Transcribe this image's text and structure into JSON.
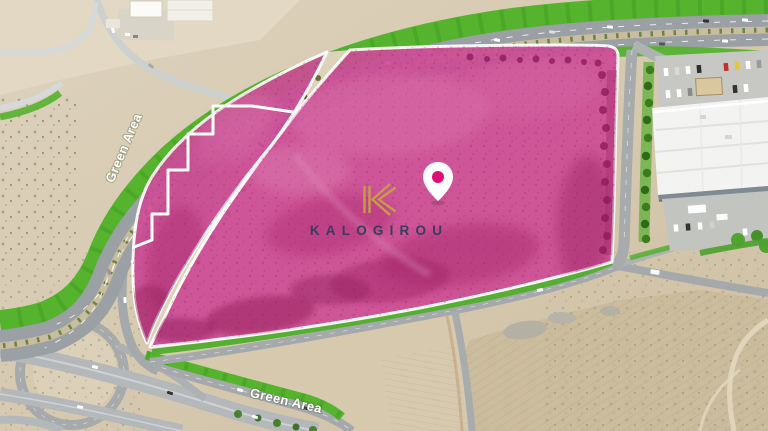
{
  "map": {
    "type": "satellite-aerial-parcel-map",
    "annotations": {
      "green_area_label_left": "Green Area",
      "green_area_label_bottom": "Green Area"
    },
    "brand": {
      "wordmark": "KALOGIROU",
      "logo_icon": "kalogirou-k-monogram"
    },
    "marker": {
      "name": "location-pin"
    },
    "overlay": {
      "highlighted_parcels": 2,
      "boundary_style": "white-outline"
    },
    "colors": {
      "parcel_overlay": "#ce4d96",
      "parcel_overlay_deep": "#a62a6e",
      "green_area": "#55b32e",
      "brand_gold": "#c89a4b",
      "brand_navy": "#383d60",
      "pin_accent": "#e00d72",
      "boundary_white": "#ffffff"
    }
  }
}
